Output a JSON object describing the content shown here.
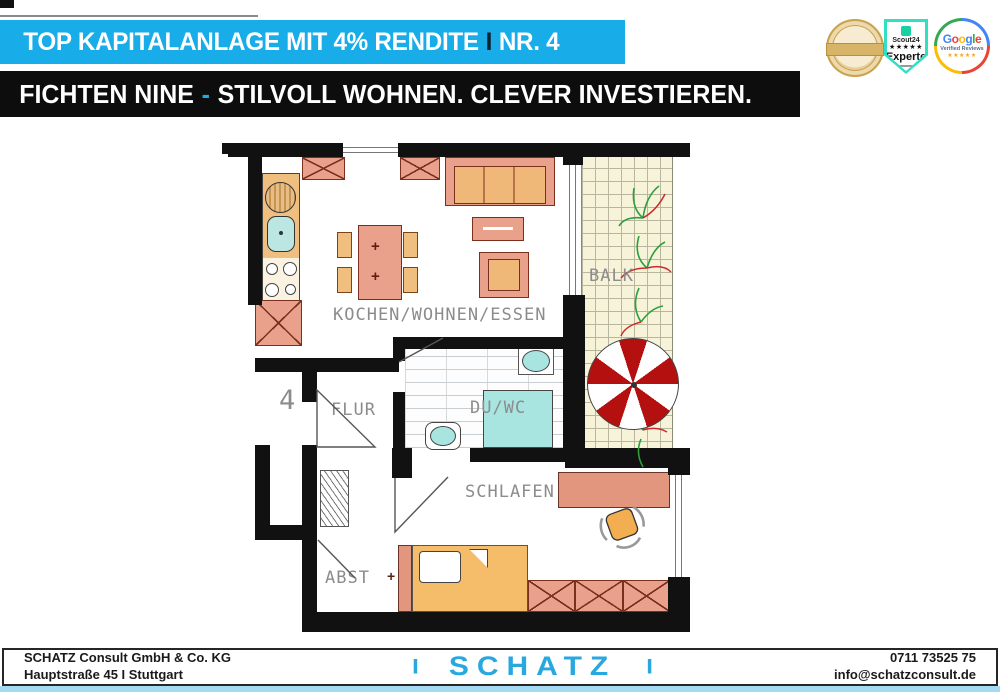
{
  "top_banner": {
    "text": "TOP KAPITALANLAGE MIT 4% RENDITE",
    "sep": "I",
    "tail": "NR. 4"
  },
  "sub_banner": {
    "lead": "FICHTEN NINE",
    "dash": "-",
    "tail": "STILVOLL WOHNEN. CLEVER INVESTIEREN."
  },
  "badges": {
    "immoscout": {
      "brand": "Scout24",
      "stars": "★★★★★",
      "label": "Experte"
    },
    "google": {
      "letters": [
        "G",
        "o",
        "o",
        "g",
        "l",
        "e"
      ],
      "label": "Verified Reviews",
      "stars": "★★★★★"
    }
  },
  "floorplan": {
    "unit_number": "4",
    "labels": {
      "kitchen_living": "KOCHEN/WOHNEN/ESSEN",
      "balcony": "BALK",
      "bath": "DU/WC",
      "hall": "FLUR",
      "bedroom": "SCHLAFEN",
      "storage": "ABST"
    }
  },
  "footer": {
    "company": "SCHATZ Consult GmbH & Co. KG",
    "address": "Hauptstraße 45 I Stuttgart",
    "logo_left": "I",
    "logo_name": "SCHATZ",
    "logo_right": "I",
    "phone": "0711 73525 75",
    "email": "info@schatzconsult.de"
  },
  "colors": {
    "accent_cyan": "#18ADE8",
    "banner_black": "#0D0D0D",
    "wall_black": "#111111",
    "furniture_salmon": "#E9A18B",
    "furniture_line": "#7A2F1F",
    "furniture_wood": "#F0BE7E",
    "sanitary_aqua": "#A8E4E0",
    "balcony_cream": "#F6F3D9",
    "parasol_red": "#B51010",
    "label_gray": "#8C8C8C",
    "footer_logo_cyan": "#29A8E0",
    "bottom_strip": "#A5DBF2"
  }
}
